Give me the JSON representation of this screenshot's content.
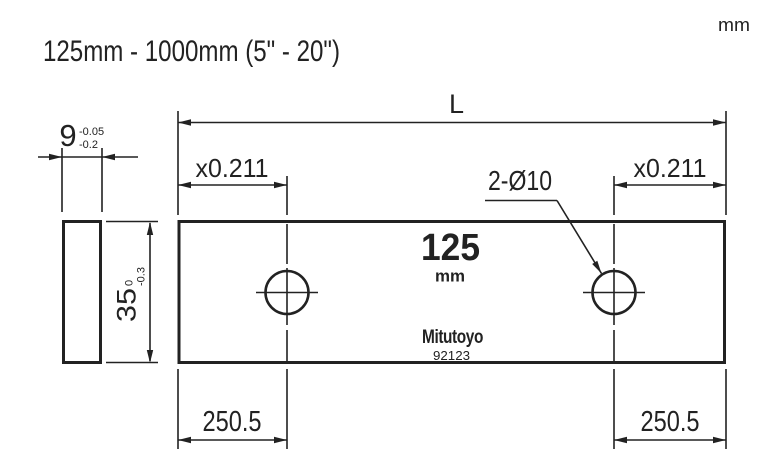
{
  "header": {
    "unit_note": "mm",
    "range_title": "125mm - 1000mm (5\" - 20\")"
  },
  "front_view": {
    "length_label": "L",
    "left_offset_label": "x0.211",
    "right_offset_label": "x0.211",
    "holes_label": "2-Ø10",
    "left_hole_offset": "250.5",
    "right_hole_offset": "250.5",
    "marking": {
      "size_value": "125",
      "size_unit": "mm",
      "brand": "Mitutoyo",
      "code": "92123"
    }
  },
  "side_view": {
    "thickness_value": "9",
    "thickness_tol_upper": "-0.05",
    "thickness_tol_lower": "-0.2",
    "height_value": "35",
    "height_tol_upper": "0",
    "height_tol_lower": "-0.3"
  },
  "colors": {
    "ink": "#222222",
    "background": "#ffffff"
  }
}
